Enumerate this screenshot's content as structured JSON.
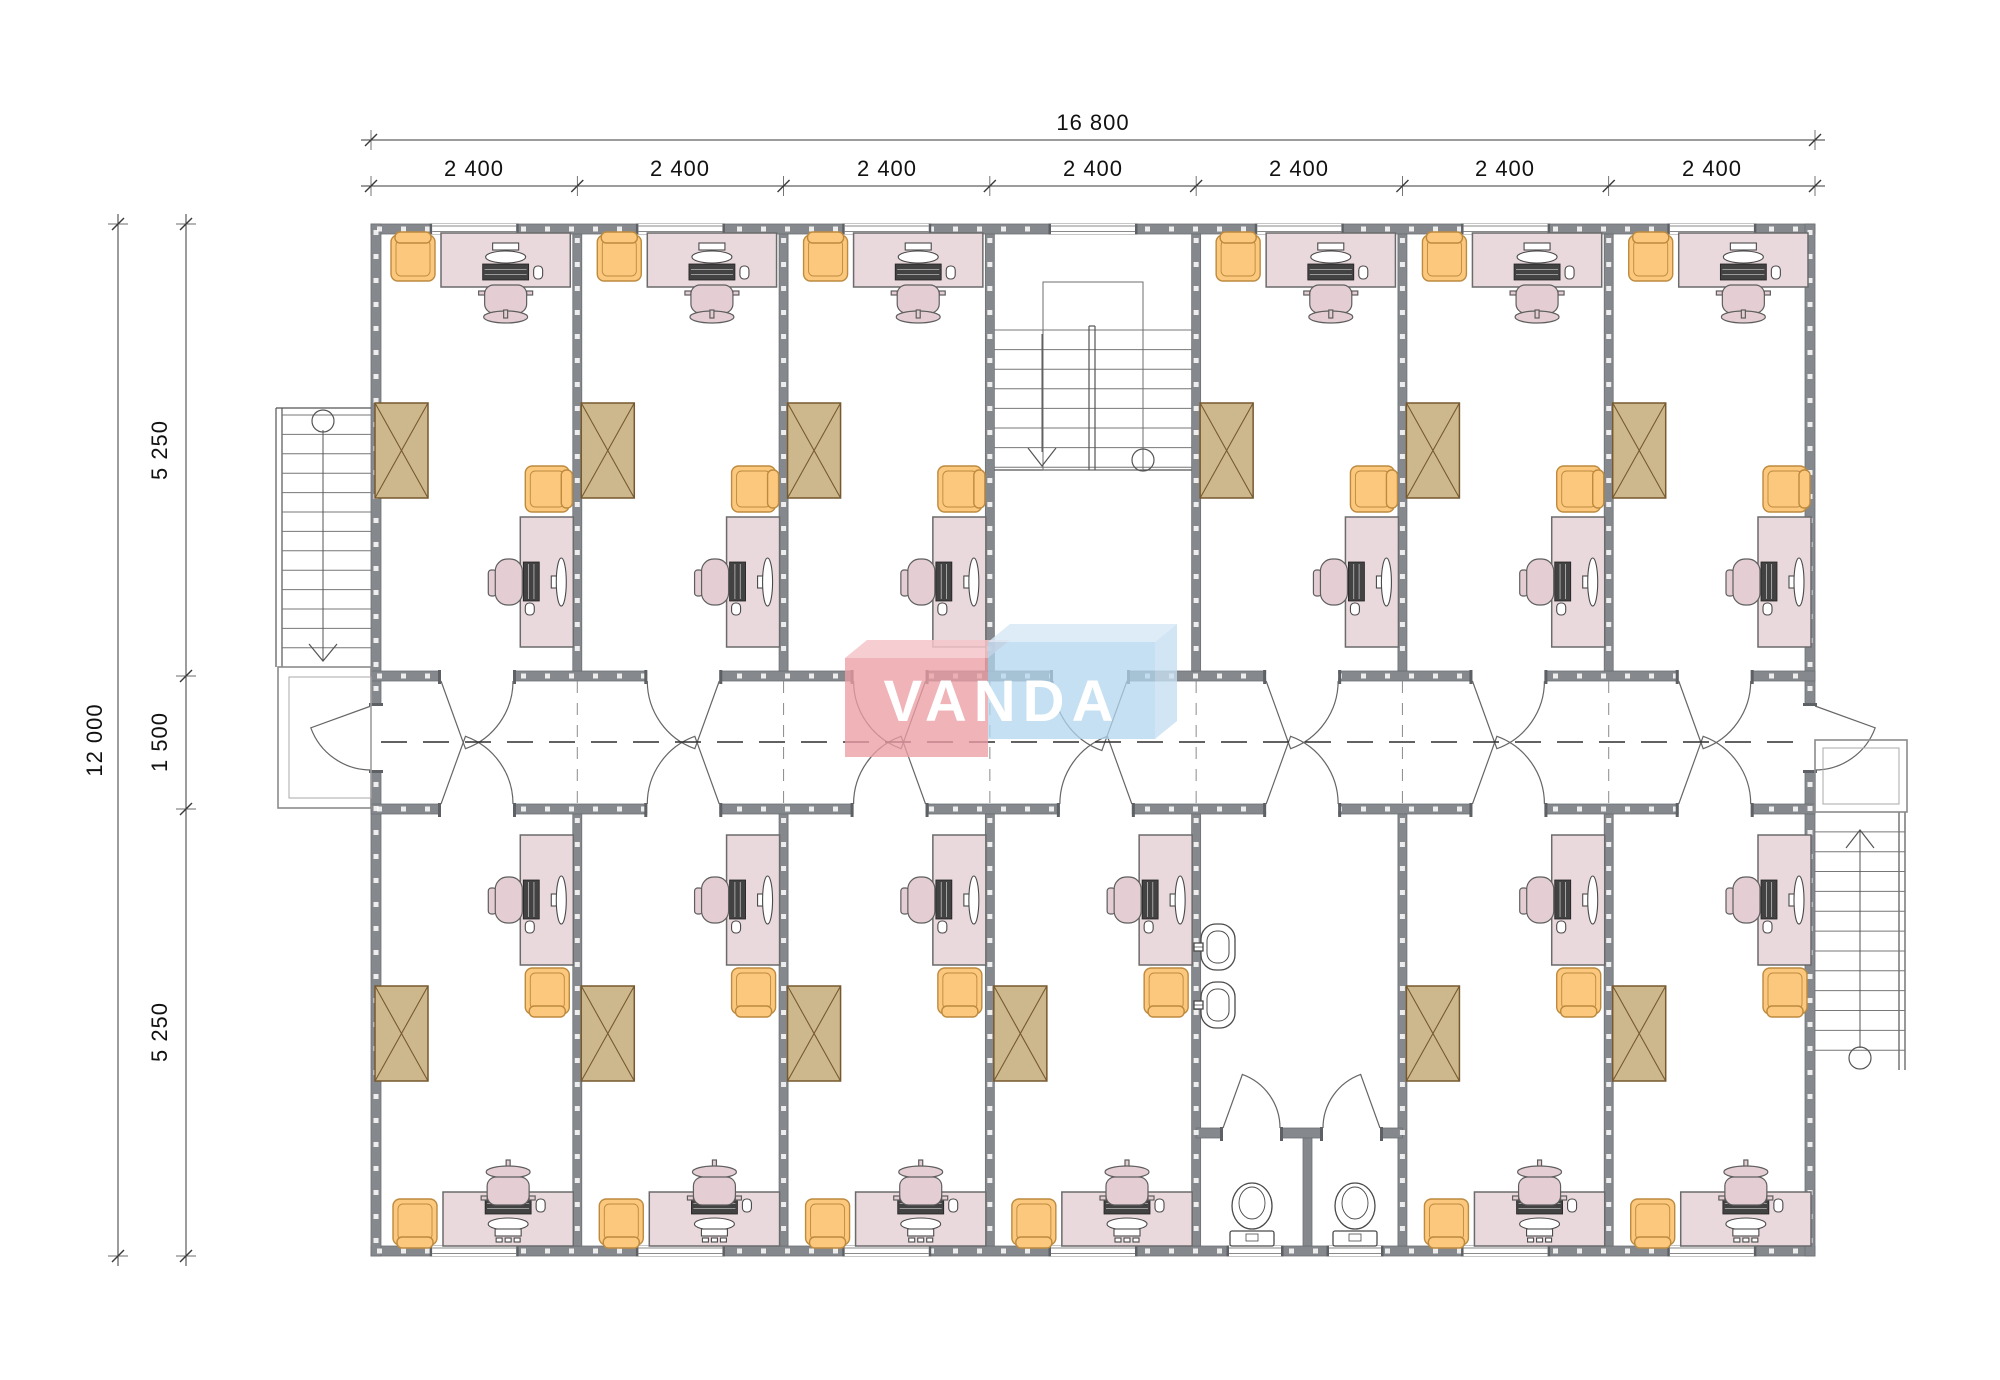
{
  "drawing": {
    "type": "architectural floor plan",
    "logo_text": "VANDA"
  },
  "dimensions": {
    "top_total": "16 800",
    "top_segments": [
      "2 400",
      "2 400",
      "2 400",
      "2 400",
      "2 400",
      "2 400",
      "2 400"
    ],
    "left_total": "12 000",
    "left_top": "5 250",
    "left_middle": "1 500",
    "left_bottom": "5 250"
  },
  "colors": {
    "wall": "#85898d",
    "desk": "#e9d9dc",
    "chair_pink": "#e4ced3",
    "chair_orange": "#fbc87e",
    "wardrobe": "#cdb88d",
    "logo_pink": "#ef9ea4",
    "logo_blue": "#b0d4ec",
    "paper": "#ffffff"
  }
}
